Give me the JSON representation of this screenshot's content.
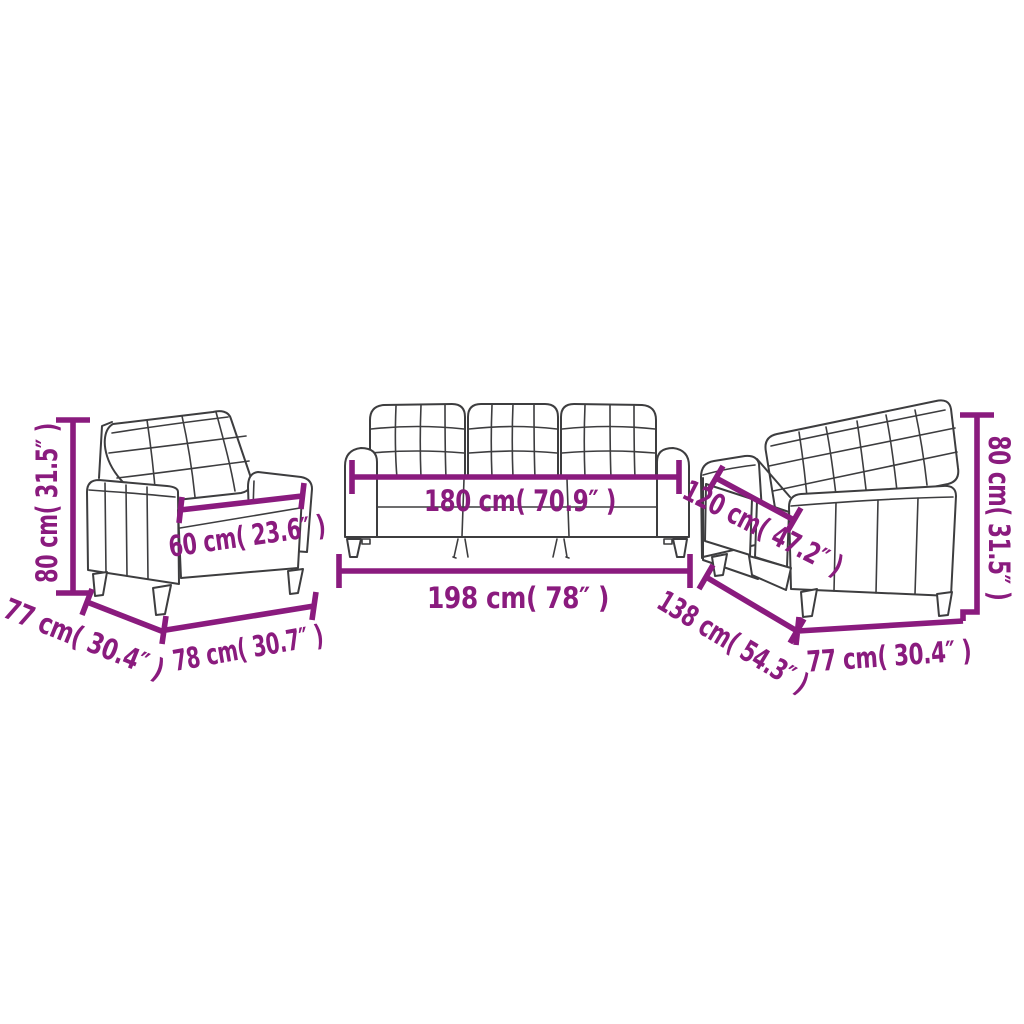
{
  "colors": {
    "accent": "#8A1B7E",
    "sketch": "#3D3D3F",
    "background": "#FFFFFF"
  },
  "pieces": [
    {
      "name": "armchair",
      "dims": {
        "height": "80 cm( 31.5″ )",
        "depth": "77 cm( 30.4″ )",
        "width": "78 cm( 30.7″ )",
        "seat_width": "60 cm( 23.6″ )"
      }
    },
    {
      "name": "three-seater-sofa",
      "dims": {
        "seat_width": "180 cm( 70.9″ )",
        "width": "198 cm( 78″ )"
      }
    },
    {
      "name": "two-seater-sofa",
      "dims": {
        "seat_width": "120 cm( 47.2″ )",
        "width": "138 cm( 54.3″ )",
        "depth": "77 cm( 30.4″ )",
        "height": "80 cm( 31.5″ )"
      }
    }
  ]
}
